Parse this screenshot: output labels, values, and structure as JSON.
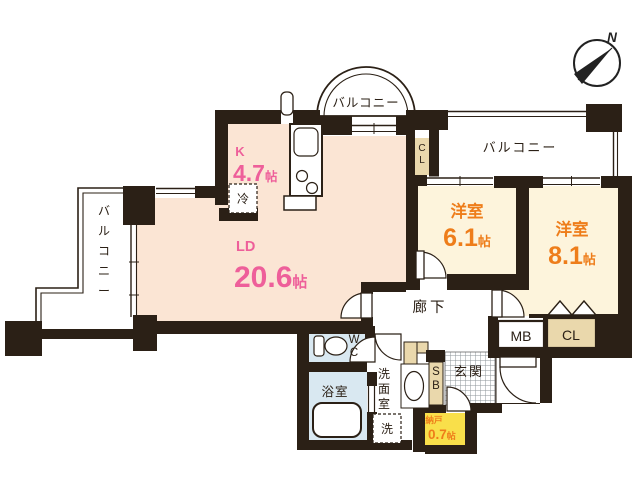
{
  "compass": {
    "north_label": "N"
  },
  "balcony_top": {
    "label": "バルコニー"
  },
  "balcony_right": {
    "label": "バルコニー"
  },
  "balcony_left": {
    "label": "バルコニー"
  },
  "kitchen": {
    "abbr": "K",
    "area_num": "4.7",
    "area_unit": "帖",
    "fridge_label": "冷"
  },
  "living_dining": {
    "abbr": "LD",
    "area_num": "20.6",
    "area_unit": "帖"
  },
  "bedroom_1": {
    "name": "洋室",
    "area_num": "6.1",
    "area_unit": "帖"
  },
  "bedroom_2": {
    "name": "洋室",
    "area_num": "8.1",
    "area_unit": "帖"
  },
  "hallway": {
    "label": "廊下"
  },
  "toilet": {
    "label": "WC"
  },
  "bathroom": {
    "label": "浴室"
  },
  "washroom": {
    "label": "洗面室",
    "washer_label": "洗"
  },
  "entrance": {
    "label": "玄関"
  },
  "storage": {
    "name": "納戸",
    "area_num": "0.7",
    "area_unit": "帖"
  },
  "shoe_box": {
    "label": "SB"
  },
  "meter_box": {
    "label": "MB"
  },
  "closet_hall": {
    "label": "CL"
  },
  "closet_bedroom2": {
    "label": "CL"
  },
  "colors": {
    "wall": "#2b2016",
    "ldk_floor": "#fbe5d4",
    "bedroom_floor": "#fdf4dc",
    "unit_label_pink": "#ee5f9a",
    "room_label_orange": "#ee7d1a",
    "storage_yellow": "#f9df4a",
    "closet_beige": "#ead8ac",
    "wet_area_blue": "#d9e8f1"
  }
}
